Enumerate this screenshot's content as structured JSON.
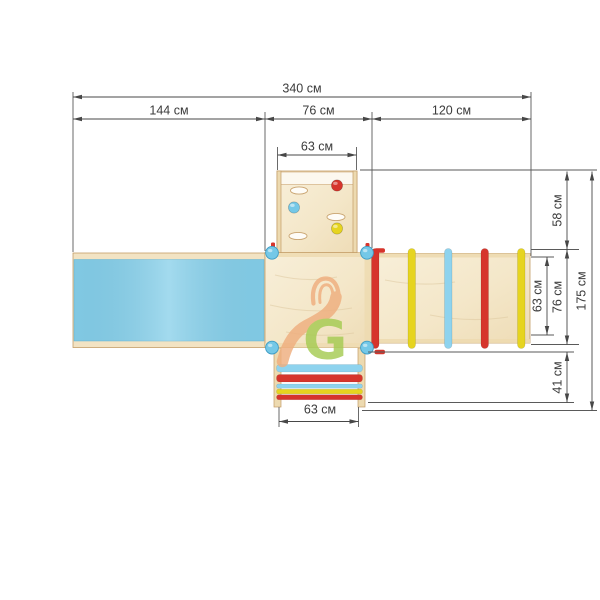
{
  "drawing": {
    "type": "playground-equipment-top-view",
    "unit_label": "см"
  },
  "dims": {
    "overall_width": "340 см",
    "slide_section": "144 см",
    "platform_section": "76 см",
    "ladder_section": "120 см",
    "climbing_wall_width": "63 см",
    "upper_right_depth": "58 см",
    "rung_length": "63 см",
    "ladder_depth": "76 см",
    "lower_right_depth": "41 см",
    "overall_depth": "175 см",
    "lower_ladder_width": "63 см"
  },
  "watermark": {
    "letter": "G"
  },
  "colors": {
    "slide_blue": "#86cfe9",
    "post_blue": "#74c8e7",
    "rung_blue": "#8ed3ee",
    "accent_red": "#d6352c",
    "accent_yellow": "#e6d41f",
    "wood_light": "#f6ecd3",
    "wood_edge": "#c49d67",
    "dim_line": "#4a4a4a",
    "watermark_orange": "#efae7e",
    "watermark_green": "#a5cb52"
  }
}
